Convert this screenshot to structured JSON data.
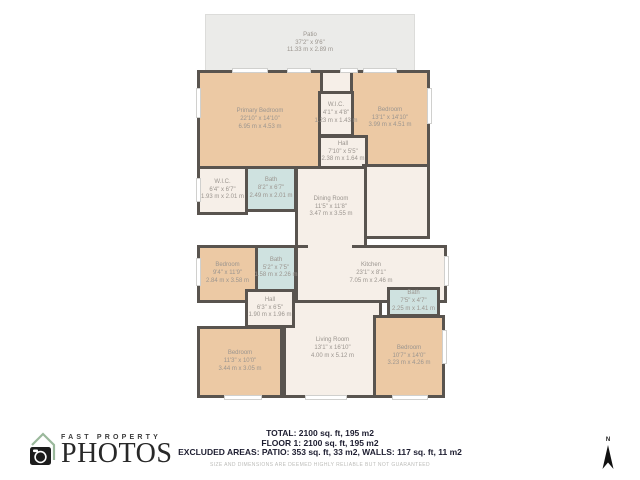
{
  "colors": {
    "wall": "#59544f",
    "bedroom-fill": "#ecc9a4",
    "bath-fill": "#cfe2e0",
    "floor-fill": "#f6efe8",
    "patio-fill": "#ebebe9",
    "label-text": "#9b958f",
    "footer-text": "#1d1d30",
    "disclaimer-text": "#bcbcb9",
    "logo-text": "#282828",
    "logo-roof": "#9ab89b"
  },
  "plan": {
    "patio": {
      "name": "Patio",
      "imperial": "37'2\" x 9'6\"",
      "metric": "11.33 m x 2.89 m"
    },
    "rooms": {
      "primary_bedroom": {
        "name": "Primary Bedroom",
        "imperial": "22'10\" x 14'10\"",
        "metric": "6.95 m x 4.53 m"
      },
      "wic_top": {
        "name": "W.I.C.",
        "imperial": "4'1\" x 4'8\"",
        "metric": "1.23 m x 1.43 m"
      },
      "bedroom_top_right": {
        "name": "Bedroom",
        "imperial": "13'1\" x 14'10\"",
        "metric": "3.99 m x 4.51 m"
      },
      "hall_top": {
        "name": "Hall",
        "imperial": "7'10\" x 5'5\"",
        "metric": "2.38 m x 1.64 m"
      },
      "wic_left": {
        "name": "W.I.C.",
        "imperial": "6'4\" x 6'7\"",
        "metric": "1.93 m x 2.01 m"
      },
      "bath_top": {
        "name": "Bath",
        "imperial": "8'2\" x 6'7\"",
        "metric": "2.49 m x 2.01 m"
      },
      "dining_room": {
        "name": "Dining Room",
        "imperial": "11'5\" x 11'8\"",
        "metric": "3.47 m x 3.55 m"
      },
      "bedroom_mid_left": {
        "name": "Bedroom",
        "imperial": "9'4\" x 11'9\"",
        "metric": "2.84 m x 3.58 m"
      },
      "bath_mid": {
        "name": "Bath",
        "imperial": "5'2\" x 7'5\"",
        "metric": "1.58 m x 2.26 m"
      },
      "kitchen": {
        "name": "Kitchen",
        "imperial": "23'1\" x 8'1\"",
        "metric": "7.05 m x 2.46 m"
      },
      "hall_lower": {
        "name": "Hall",
        "imperial": "6'3\" x 6'5\"",
        "metric": "1.90 m x 1.96 m"
      },
      "living_room": {
        "name": "Living Room",
        "imperial": "13'1\" x 16'10\"",
        "metric": "4.00 m x 5.12 m"
      },
      "bath_right": {
        "name": "Bath",
        "imperial": "7'5\" x 4'7\"",
        "metric": "2.25 m x 1.41 m"
      },
      "bedroom_bottom_right": {
        "name": "Bedroom",
        "imperial": "10'7\" x 14'0\"",
        "metric": "3.23 m x 4.26 m"
      },
      "bedroom_bottom_left": {
        "name": "Bedroom",
        "imperial": "11'3\" x 10'0\"",
        "metric": "3.44 m x 3.05 m"
      }
    }
  },
  "footer": {
    "total": "TOTAL: 2100 sq. ft, 195 m2",
    "floor": "FLOOR 1: 2100 sq. ft, 195 m2",
    "excluded": "EXCLUDED AREAS: PATIO: 353 sq. ft, 33 m2, WALLS: 117 sq. ft, 11 m2",
    "disclaimer": "SIZE AND DIMENSIONS ARE DEEMED HIGHLY RELIABLE BUT NOT GUARANTEED"
  },
  "logo": {
    "line1": "FAST PROPERTY",
    "line2": "PHOTOS"
  },
  "compass": {
    "label": "N"
  }
}
